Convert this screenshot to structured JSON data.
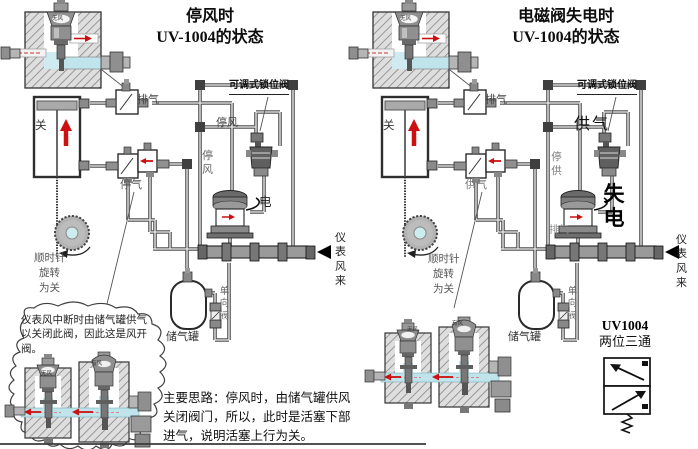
{
  "figure": {
    "type": "pneumatic-valve-state-diagram",
    "panels": 2
  },
  "left": {
    "title_line1": "停风时",
    "title_line2": "UV-1004的状态",
    "labels": {
      "exhaust": "排气",
      "lock_valve": "可调式锁位阀",
      "stop_wind_h": "停风",
      "stop_wind_v": "停风",
      "stop_air": "停气",
      "electric": "电",
      "valve_closed": "关",
      "rotation_l1": "顺时针",
      "rotation_l2": "旋转",
      "rotation_l3": "为关",
      "instrument_air": "仪表风来",
      "tank": "储气罐",
      "check_valve": "单向阀",
      "no_wind": "无风",
      "has_wind": "有风"
    },
    "cloud_note": "仪表风中断时由储气罐供气以关闭此阀，因此这是风开阀。",
    "main_idea": "主要思路：停风时，由储气罐供风关闭阀门，所以，此时是活塞下部进气，说明活塞上行为关。"
  },
  "right": {
    "title_line1": "电磁阀失电时",
    "title_line2": "UV-1004的状态",
    "labels": {
      "exhaust": "排气",
      "lock_valve": "可调式锁位阀",
      "supply": "供气",
      "stop_supply_v": "停供",
      "supply_small": "供气",
      "lost_power": "失电",
      "exhaust_small": "排气",
      "valve_closed": "关",
      "rotation_l1": "顺时针",
      "rotation_l2": "旋转",
      "rotation_l3": "为关",
      "instrument_air": "仪表风来",
      "tank": "储气罐",
      "check_valve": "单向阀",
      "no_wind": "无风",
      "has_wind": "有风",
      "uv_title": "UV1004",
      "uv_subtitle": "两位三通"
    }
  },
  "colors": {
    "background": "#ffffff",
    "pipe": "#4f4f4f",
    "flow_arrow_red": "#cc1111",
    "air_passage_blue": "#bfe4ec",
    "hatch_block_gray": "#dedede"
  }
}
